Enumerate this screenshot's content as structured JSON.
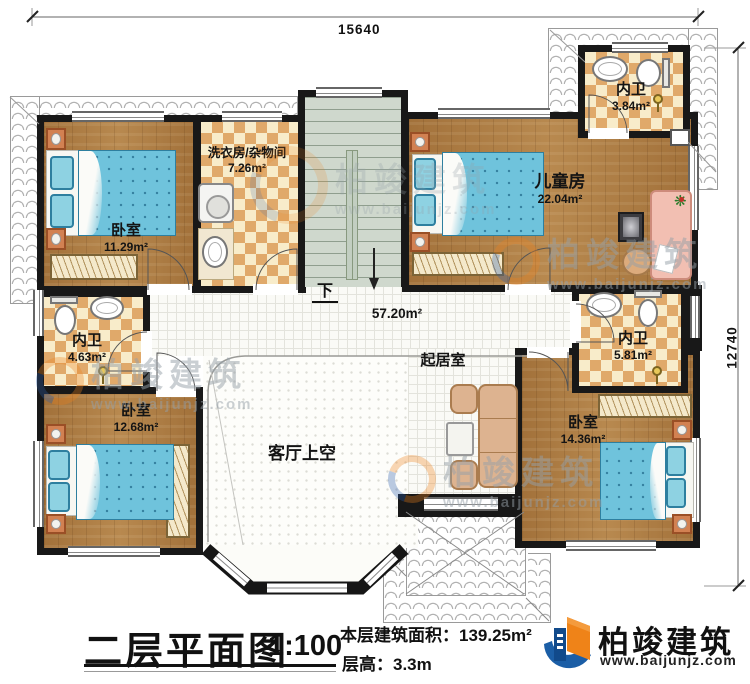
{
  "dimensions": {
    "width": "15640",
    "height": "12740"
  },
  "rooms": {
    "bedroom_tl": {
      "name": "卧室",
      "area": "11.29m²"
    },
    "laundry": {
      "name": "洗衣房/杂物间",
      "area": "7.26m²"
    },
    "kids_room": {
      "name": "儿童房",
      "area": "22.04m²"
    },
    "bath_top": {
      "name": "内卫",
      "area": "3.84m²"
    },
    "bath_left": {
      "name": "内卫",
      "area": "4.63m²"
    },
    "bath_right": {
      "name": "内卫",
      "area": "5.81m²"
    },
    "bedroom_bl": {
      "name": "卧室",
      "area": "12.68m²"
    },
    "bedroom_br": {
      "name": "卧室",
      "area": "14.36m²"
    },
    "hallway": {
      "area": "57.20m²"
    },
    "stairs": {
      "down_label": "下"
    },
    "living_void": {
      "name": "客厅上空"
    },
    "sitting": {
      "name": "起居室"
    }
  },
  "title_block": {
    "title": "二层平面图",
    "scale": "1:100",
    "area_label": "本层建筑面积：",
    "area_value": "139.25m²",
    "floor_height_label": "层高：",
    "floor_height_value": "3.3m"
  },
  "brand": {
    "name": "柏竣建筑",
    "website": "www.baijunjz.com"
  },
  "watermark": {
    "name": "柏竣建筑",
    "website": "www.baijunjz.com"
  },
  "colors": {
    "wall": "#181818",
    "wood": "#aa7b41",
    "tile": "#e0a96a",
    "stair": "#cfd8cd",
    "bed": "#6fc3dc",
    "brand_orange": "#ef8318",
    "brand_blue": "#1b5ea6"
  }
}
